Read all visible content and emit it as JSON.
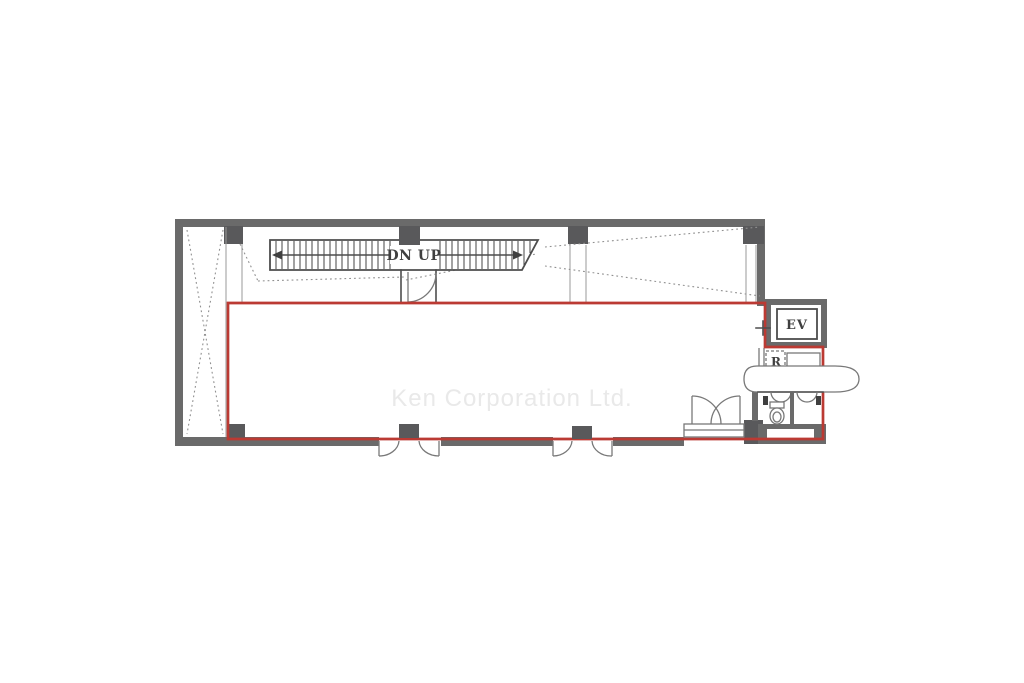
{
  "floor_plan": {
    "watermark": "Ken Corporation Ltd.",
    "stairs": {
      "label": "DN UP"
    },
    "elevator": {
      "label": "EV"
    },
    "utility": {
      "label": "R"
    },
    "colors": {
      "background": "#ffffff",
      "wall": "#6a6a6a",
      "column": "#59595b",
      "line": "#4d4d4d",
      "fixture": "#787878",
      "dotted": "#909090",
      "lease_outline": "#bb3a33",
      "watermark_text": "#e9e9e9"
    }
  }
}
